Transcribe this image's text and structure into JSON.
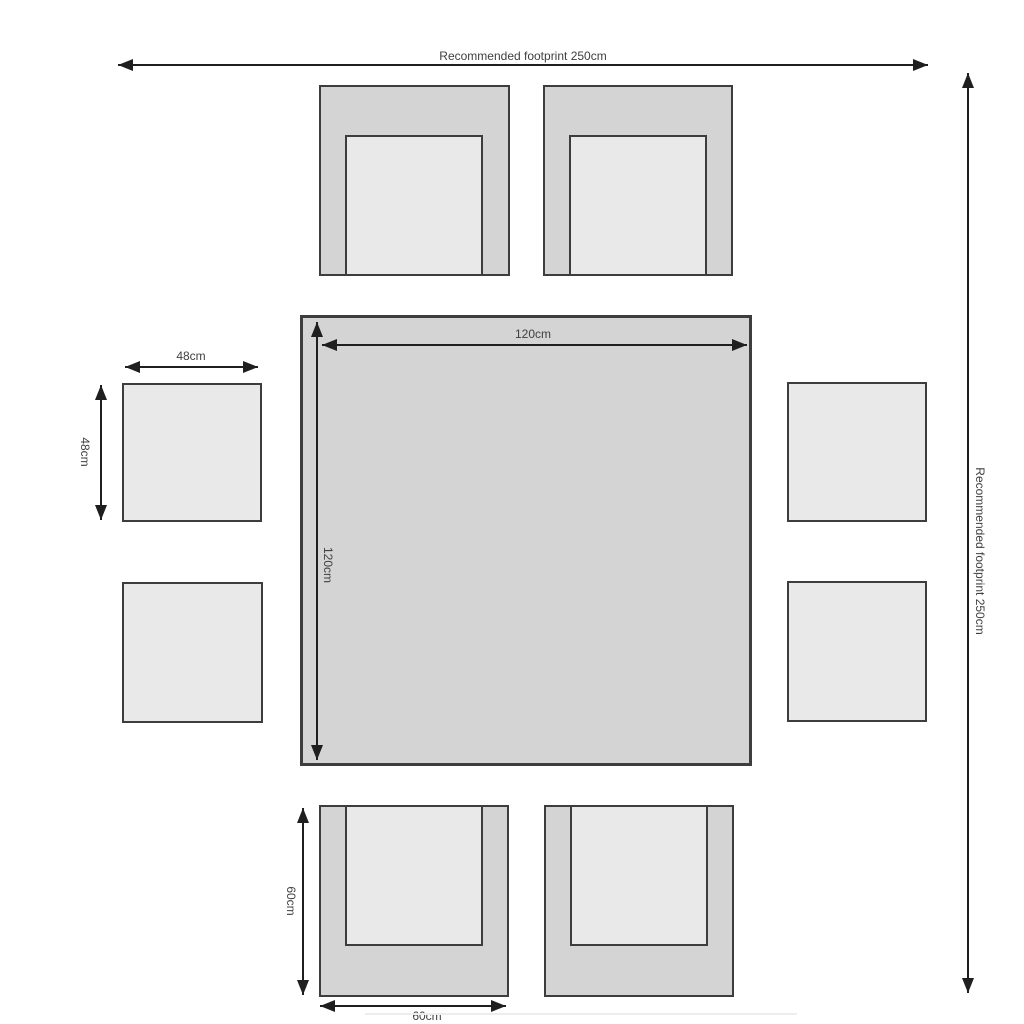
{
  "footprint": {
    "top_label": "Recommended footprint 250cm",
    "right_label": "Recommended footprint 250cm"
  },
  "table": {
    "width_label": "120cm",
    "depth_label": "120cm"
  },
  "stool": {
    "width_label": "48cm",
    "depth_label": "48cm"
  },
  "chair": {
    "width_label": "60cm",
    "depth_label": "60cm"
  },
  "colors": {
    "background": "#ffffff",
    "frame_fill": "#d4d4d4",
    "cushion_fill": "#e9e9e9",
    "outline": "#3d3d3d",
    "arrow": "#1f1f1f",
    "text": "#404040"
  }
}
